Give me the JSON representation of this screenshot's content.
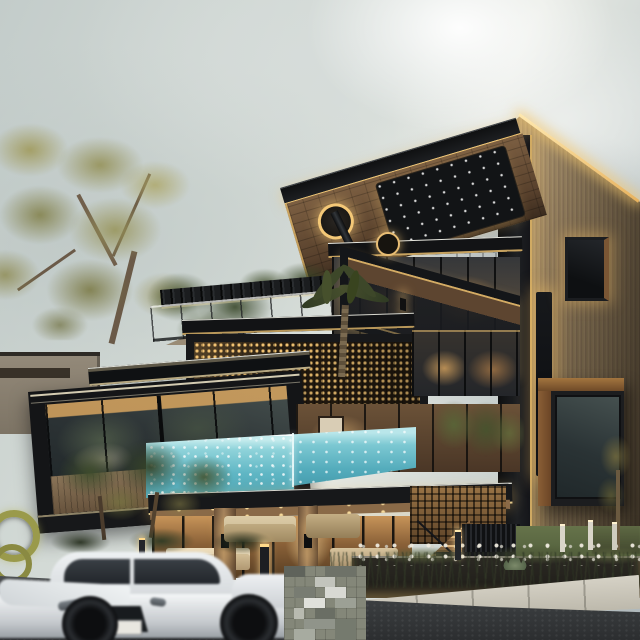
{
  "scene": {
    "title": "Modern multi-storey luxury villa at dusk with cantilevered canopy, wood-slat tower, glass infinity pool and a white sports car passing on the street",
    "time_of_day": "dusk",
    "weather": "overcast",
    "objects": [
      "cantilevered black canopy with amber LED strips and starlight soffit panel",
      "vertical wood-slat tower with recessed glowing window slot and projecting glass box window",
      "stacked glass floors with warm interior lighting",
      "golden perforated mesh screen facade box",
      "glass-walled aqua infinity pool wrapping the corner",
      "rooftop terrace with glass railing and pergola",
      "palm tree and landscaped garden with bollard lights",
      "white sports coupe in motion blur",
      "pixelated watermark block on the pavement"
    ],
    "palette": {
      "sky": "#cfd6d3",
      "structure_black": "#17181a",
      "led_amber": "#f2c672",
      "wood_slat": "#97825f",
      "soffit_wood": "#6b5340",
      "pool_aqua": "#7fccd4",
      "interior_warm": "#d9a560",
      "foliage_olive": "#8f8a4e",
      "foliage_green": "#3c4a2c",
      "road": "#3a3d3f",
      "sidewalk": "#c6c2b6",
      "car_white": "#eef0f2"
    }
  },
  "watermark": {
    "present": true,
    "type": "pixelated-mosaic"
  }
}
